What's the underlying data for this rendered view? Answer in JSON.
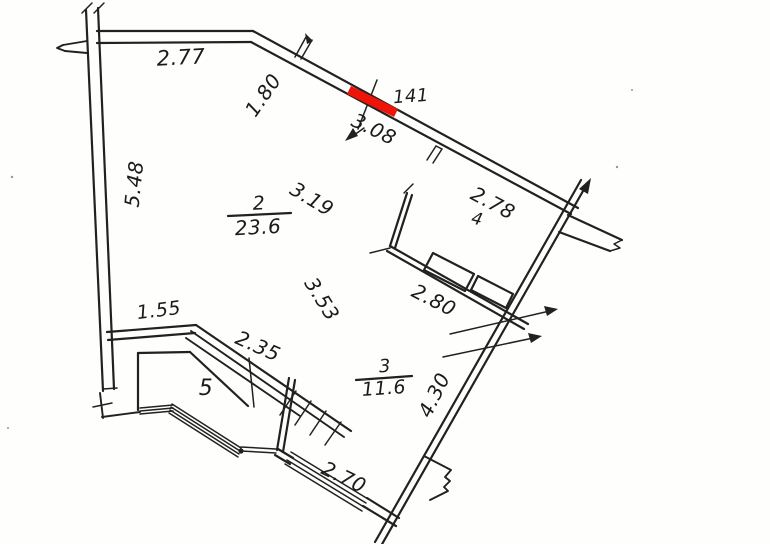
{
  "plan_type_note": "apartment floor plan, scanned line drawing",
  "colors": {
    "line": "#212121",
    "highlight": "#ee1409",
    "background": "#fefefd"
  },
  "rooms": [
    {
      "number": "2",
      "area": "23.6"
    },
    {
      "number": "3",
      "area": "11.6"
    },
    {
      "number": "4",
      "area": ""
    },
    {
      "number": "5",
      "area": ""
    }
  ],
  "dimensions": [
    {
      "id": "top-wall",
      "value": "2.77"
    },
    {
      "id": "upper-diagonal-left",
      "value": "1.80"
    },
    {
      "id": "highlight-length",
      "value": "141"
    },
    {
      "id": "diagonal-opening",
      "value": "3.08"
    },
    {
      "id": "diagonal-right",
      "value": "2.78"
    },
    {
      "id": "left-wall",
      "value": "5.48"
    },
    {
      "id": "room2-width",
      "value": "3.19"
    },
    {
      "id": "room2-depth",
      "value": "3.53"
    },
    {
      "id": "partition-wall",
      "value": "2.80"
    },
    {
      "id": "balcony-top",
      "value": "1.55"
    },
    {
      "id": "staircase",
      "value": "2.35"
    },
    {
      "id": "room3-right",
      "value": "4.30"
    },
    {
      "id": "room3-bottom",
      "value": "2.70"
    }
  ]
}
